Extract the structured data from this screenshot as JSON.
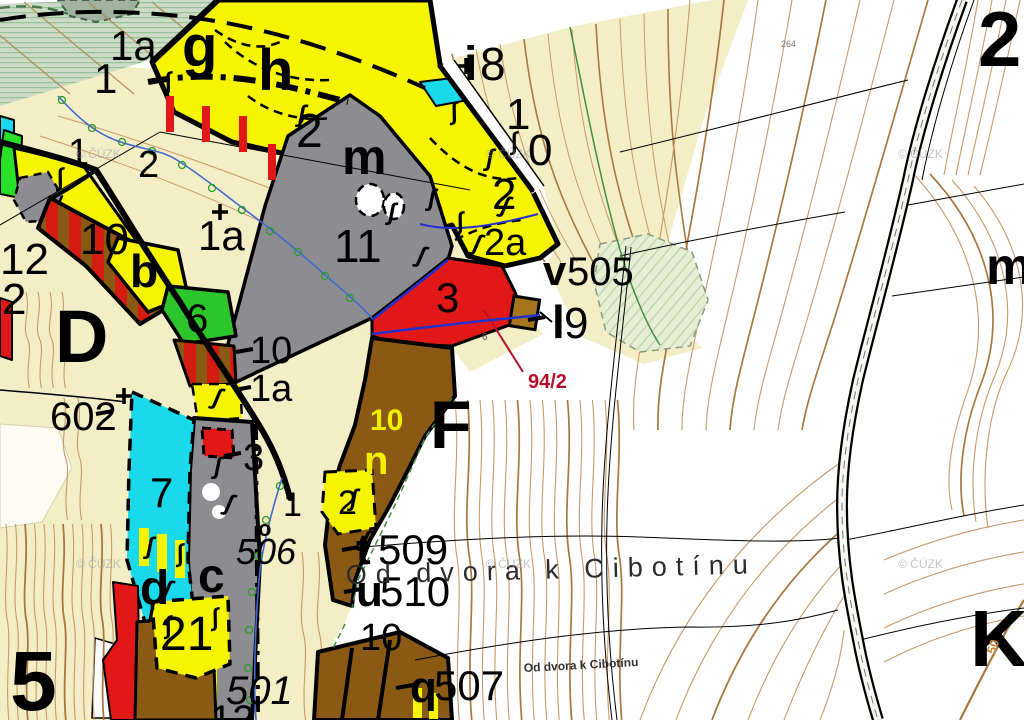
{
  "map": {
    "labels": [
      {
        "t": "1a",
        "x": 110,
        "y": 60,
        "s": 42,
        "w": 600
      },
      {
        "t": "1",
        "x": 94,
        "y": 93,
        "s": 42,
        "w": 600
      },
      {
        "t": "g",
        "x": 182,
        "y": 66,
        "s": 58,
        "w": 800
      },
      {
        "t": "h",
        "x": 258,
        "y": 90,
        "s": 58,
        "w": 800
      },
      {
        "t": "2",
        "x": 296,
        "y": 147,
        "s": 48,
        "w": 600
      },
      {
        "t": "i",
        "x": 464,
        "y": 80,
        "s": 48,
        "w": 800
      },
      {
        "t": "8",
        "x": 480,
        "y": 80,
        "s": 46,
        "w": 500
      },
      {
        "t": "1",
        "x": 506,
        "y": 129,
        "s": 44,
        "w": 600
      },
      {
        "t": "0",
        "x": 528,
        "y": 165,
        "s": 44,
        "w": 600
      },
      {
        "t": "2",
        "x": 492,
        "y": 209,
        "s": 44,
        "w": 600
      },
      {
        "t": "2a",
        "x": 484,
        "y": 255,
        "s": 38,
        "w": 600
      },
      {
        "t": "m",
        "x": 342,
        "y": 174,
        "s": 50,
        "w": 800
      },
      {
        "t": "11",
        "x": 334,
        "y": 262,
        "s": 46,
        "w": 600
      },
      {
        "t": "3",
        "x": 436,
        "y": 312,
        "s": 42,
        "w": 600
      },
      {
        "t": "v",
        "x": 543,
        "y": 285,
        "s": 42,
        "w": 800
      },
      {
        "t": "505",
        "x": 567,
        "y": 285,
        "s": 40,
        "w": 500
      },
      {
        "t": "l",
        "x": 552,
        "y": 338,
        "s": 46,
        "w": 800
      },
      {
        "t": "9",
        "x": 564,
        "y": 338,
        "s": 44,
        "w": 500
      },
      {
        "t": "94/2",
        "x": 528,
        "y": 388,
        "s": 20,
        "w": 700,
        "c": "#b5102c"
      },
      {
        "t": "F",
        "x": 430,
        "y": 448,
        "s": 68,
        "w": 800
      },
      {
        "t": "m",
        "x": 986,
        "y": 284,
        "s": 52,
        "w": 800
      },
      {
        "t": "2",
        "x": 978,
        "y": 66,
        "s": 78,
        "w": 800
      },
      {
        "t": "1",
        "x": 68,
        "y": 165,
        "s": 38,
        "w": 600
      },
      {
        "t": "2",
        "x": 138,
        "y": 177,
        "s": 38,
        "w": 600
      },
      {
        "t": "1a",
        "x": 198,
        "y": 250,
        "s": 42,
        "w": 600
      },
      {
        "t": "12",
        "x": 0,
        "y": 274,
        "s": 44,
        "w": 600
      },
      {
        "t": "2",
        "x": 2,
        "y": 314,
        "s": 44,
        "w": 600
      },
      {
        "t": "10",
        "x": 80,
        "y": 254,
        "s": 44,
        "w": 600
      },
      {
        "t": "b",
        "x": 130,
        "y": 287,
        "s": 46,
        "w": 800
      },
      {
        "t": "6",
        "x": 186,
        "y": 332,
        "s": 40,
        "w": 600
      },
      {
        "t": "D",
        "x": 55,
        "y": 362,
        "s": 74,
        "w": 800
      },
      {
        "t": "10",
        "x": 250,
        "y": 363,
        "s": 38,
        "w": 600
      },
      {
        "t": "1a",
        "x": 250,
        "y": 401,
        "s": 38,
        "w": 600
      },
      {
        "t": "602",
        "x": 50,
        "y": 430,
        "s": 40,
        "w": 600
      },
      {
        "t": "3",
        "x": 243,
        "y": 470,
        "s": 38,
        "w": 600
      },
      {
        "t": "7",
        "x": 150,
        "y": 507,
        "s": 42,
        "w": 600
      },
      {
        "t": "1",
        "x": 283,
        "y": 516,
        "s": 34,
        "w": 600
      },
      {
        "t": "o",
        "x": 258,
        "y": 536,
        "s": 22,
        "w": 700
      },
      {
        "t": "506",
        "x": 236,
        "y": 564,
        "s": 36,
        "w": 500,
        "i": 1
      },
      {
        "t": "2",
        "x": 338,
        "y": 514,
        "s": 34,
        "w": 600
      },
      {
        "t": "10",
        "x": 370,
        "y": 430,
        "s": 30,
        "w": 700,
        "c": "#f2ef00"
      },
      {
        "t": "n",
        "x": 364,
        "y": 474,
        "s": 40,
        "w": 800,
        "c": "#f2ef00"
      },
      {
        "t": "d",
        "x": 140,
        "y": 604,
        "s": 48,
        "w": 800
      },
      {
        "t": "c",
        "x": 198,
        "y": 592,
        "s": 48,
        "w": 800
      },
      {
        "t": "21",
        "x": 160,
        "y": 650,
        "s": 48,
        "w": 600
      },
      {
        "t": "501",
        "x": 226,
        "y": 704,
        "s": 40,
        "w": 500,
        "i": 1
      },
      {
        "t": "12",
        "x": 210,
        "y": 733,
        "s": 40,
        "w": 600
      },
      {
        "t": "t",
        "x": 356,
        "y": 564,
        "s": 44,
        "w": 800
      },
      {
        "t": "509",
        "x": 378,
        "y": 564,
        "s": 42,
        "w": 500
      },
      {
        "t": "u",
        "x": 356,
        "y": 606,
        "s": 44,
        "w": 800
      },
      {
        "t": "510",
        "x": 380,
        "y": 606,
        "s": 42,
        "w": 500
      },
      {
        "t": "10",
        "x": 360,
        "y": 650,
        "s": 38,
        "w": 600
      },
      {
        "t": "q",
        "x": 410,
        "y": 702,
        "s": 44,
        "w": 800
      },
      {
        "t": "507",
        "x": 434,
        "y": 700,
        "s": 42,
        "w": 500
      },
      {
        "t": "5",
        "x": 10,
        "y": 710,
        "s": 84,
        "w": 800
      },
      {
        "t": "K",
        "x": 970,
        "y": 666,
        "s": 80,
        "w": 800
      },
      {
        "t": "264",
        "x": 781,
        "y": 47,
        "s": 9,
        "w": 400,
        "c": "#8a7a6a"
      },
      {
        "t": "6",
        "x": 482,
        "y": 340,
        "s": 10,
        "w": 600,
        "c": "#555555"
      },
      {
        "t": "50",
        "x": 995,
        "y": 655,
        "s": 13,
        "w": 700,
        "c": "#c8853a",
        "r": -72
      }
    ],
    "road_label_large": {
      "text": "Od dvora k Cibotínu",
      "x": 346,
      "y": 584,
      "size": 27,
      "spacing": 9,
      "rotate": -1.5,
      "color": "#2b2b2b"
    },
    "road_label_small": {
      "text": "Od dvora k Cibotínu",
      "x": 524,
      "y": 672,
      "size": 12,
      "rotate": -3,
      "color": "#333333"
    },
    "watermark": {
      "text": "© ČÚZK",
      "positions": [
        [
          76,
          158
        ],
        [
          486,
          158
        ],
        [
          898,
          158
        ],
        [
          76,
          568
        ],
        [
          486,
          568
        ],
        [
          898,
          568
        ]
      ]
    },
    "symbols": {
      "grass_glyph": "ʃ",
      "positions": [
        [
          452,
          120
        ],
        [
          486,
          166
        ],
        [
          500,
          212
        ],
        [
          458,
          230
        ],
        [
          428,
          206
        ],
        [
          472,
          250
        ],
        [
          512,
          150
        ],
        [
          388,
          220
        ],
        [
          416,
          262
        ],
        [
          166,
          90
        ],
        [
          298,
          122
        ],
        [
          212,
          404
        ],
        [
          58,
          186
        ],
        [
          146,
          554
        ],
        [
          162,
          596
        ],
        [
          178,
          562
        ],
        [
          214,
          474
        ],
        [
          224,
          510
        ],
        [
          213,
          626
        ],
        [
          350,
          506
        ],
        [
          360,
          546
        ],
        [
          166,
          634
        ],
        [
          148,
          618
        ]
      ]
    },
    "colors": {
      "beige": "#f3eec6",
      "yellow": "#f7f400",
      "gray": "#8d8d91",
      "cyan": "#19d9ea",
      "green": "#2cc52c",
      "green_bright": "#27e027",
      "red": "#e21717",
      "brown": "#8a5a15",
      "stripe_red": "#d41c10",
      "stripe_brown": "#8a5a15",
      "building": "#a5751c",
      "meadow": "#e6eed6",
      "band_green": "#ccdcc6",
      "band_line": "#96c296",
      "contour": "#c89a6a",
      "contour_bold": "#a87840",
      "stream": "#4169d0",
      "boundary_blue": "#2230cc",
      "leader_red": "#b5102c",
      "forest_edge": "#3f8f3f",
      "watermark": "#9aa0a8"
    }
  }
}
